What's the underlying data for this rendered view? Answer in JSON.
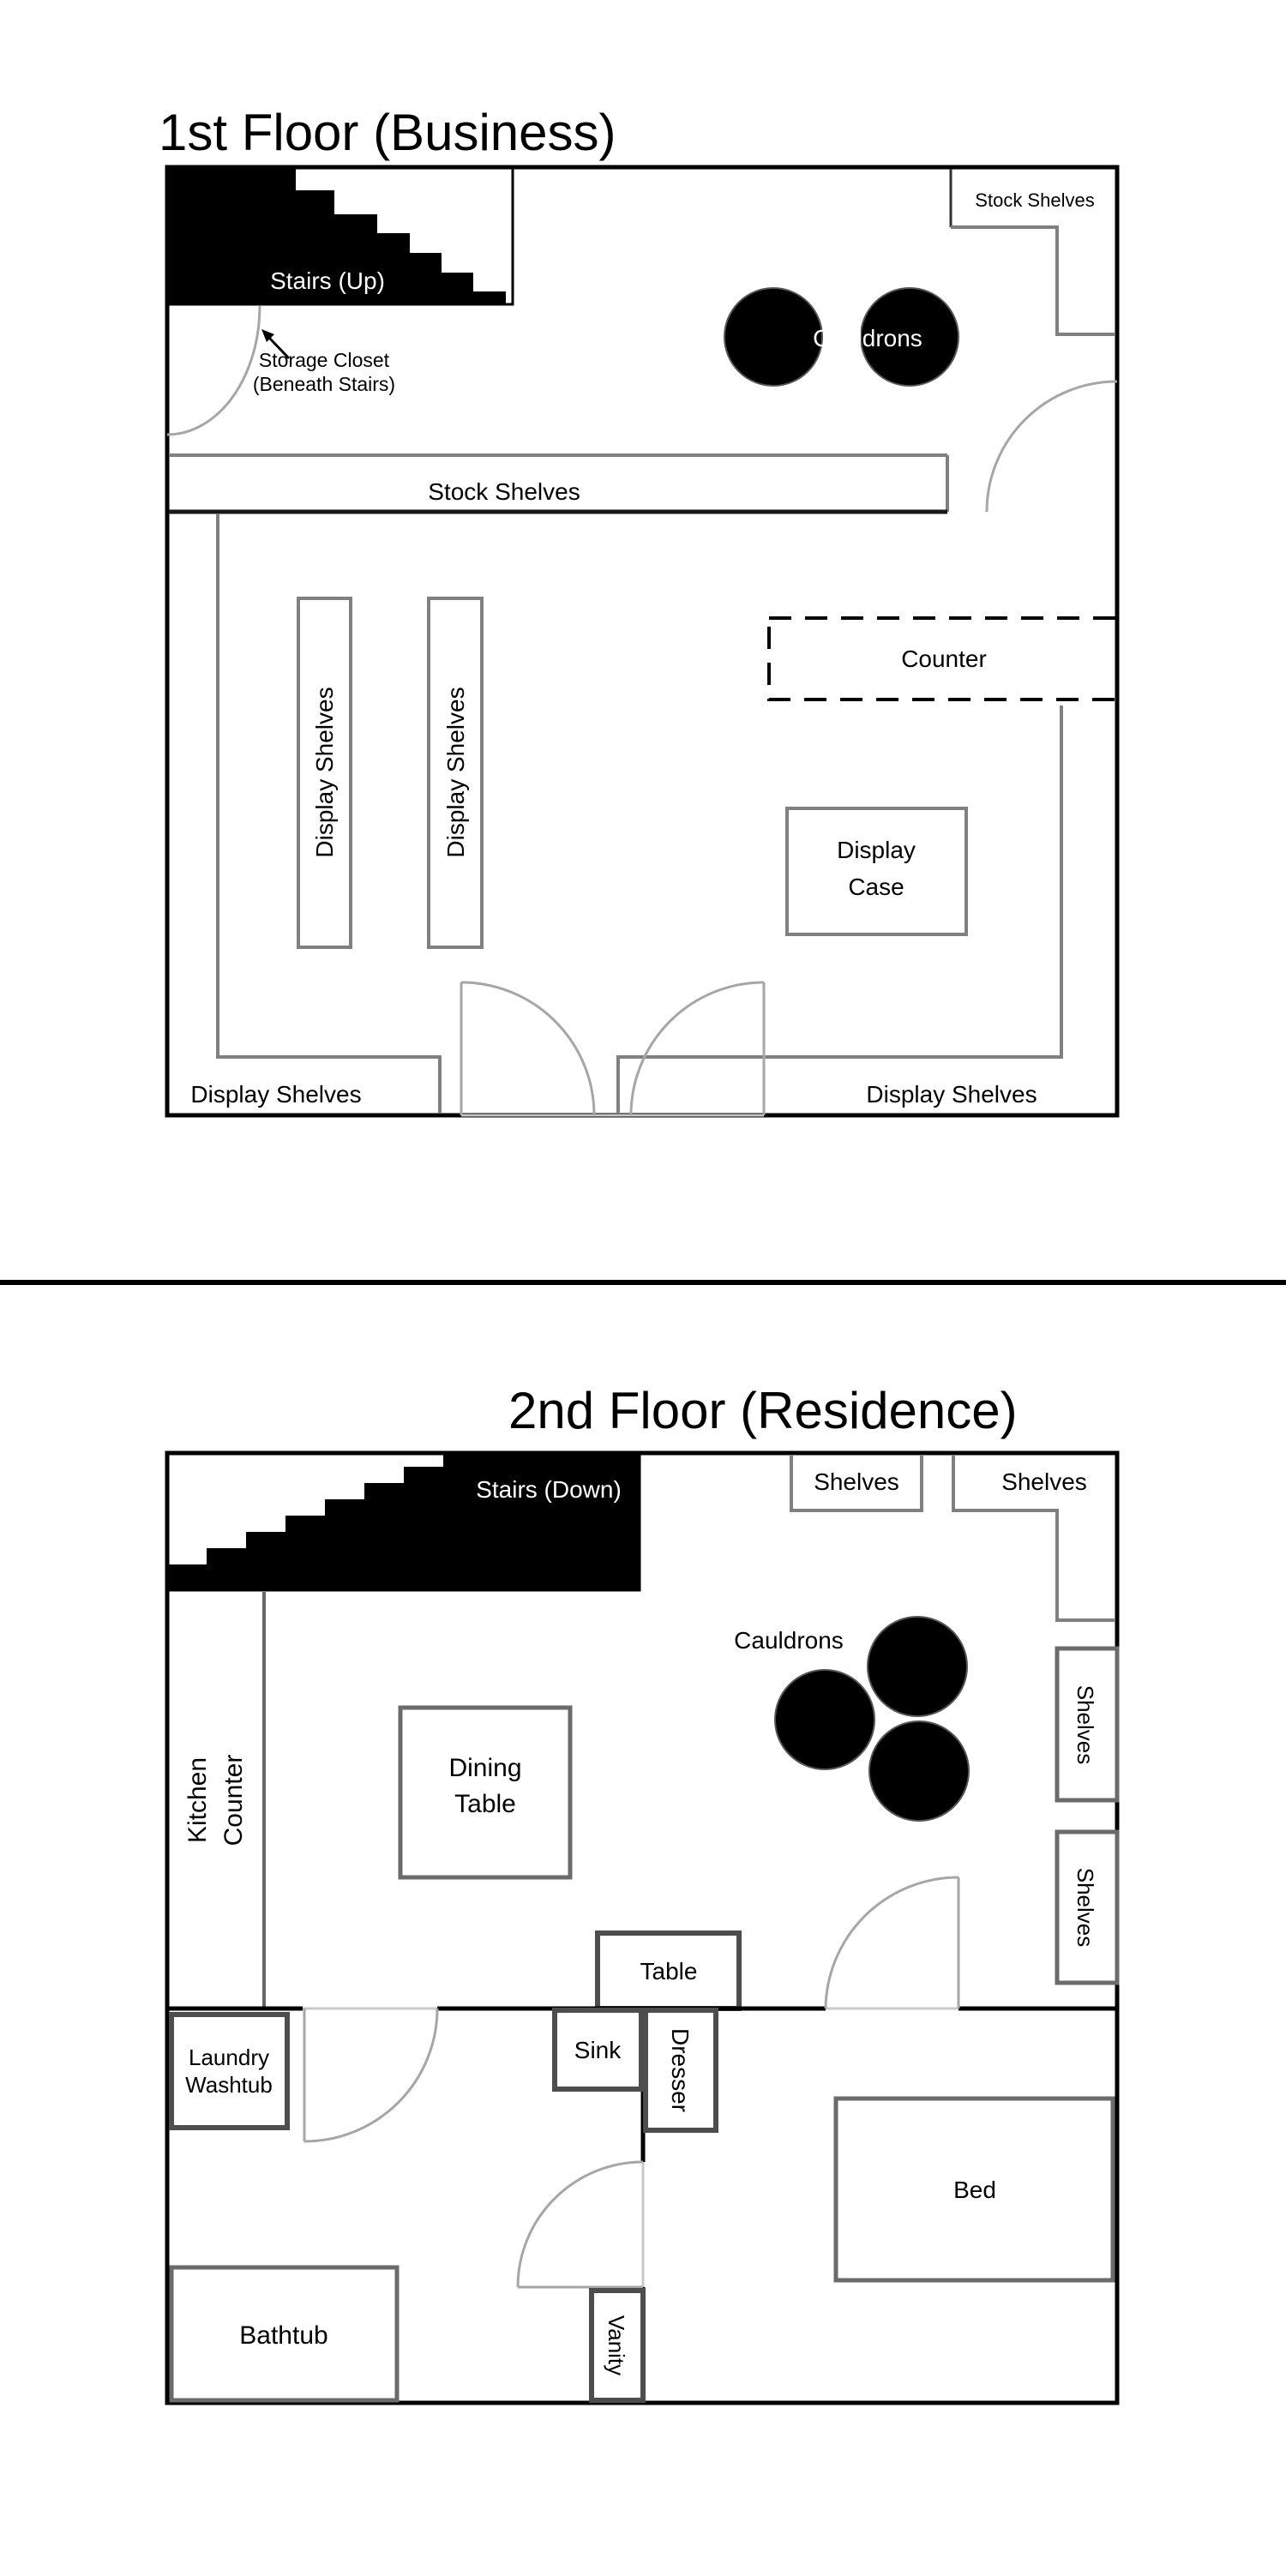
{
  "colors": {
    "wall": "#000000",
    "furniture_gray": "#808080",
    "furniture_dark": "#4d4d4d",
    "door_gray": "#a6a6a6",
    "cauldron_fill": "#000000",
    "stairs_fill": "#000000"
  },
  "floor1": {
    "title": "1st Floor (Business)",
    "stairs_label": "Stairs (Up)",
    "storage_closet_line1": "Storage Closet",
    "storage_closet_line2": "(Beneath Stairs)",
    "stock_shelves_corner_label": "Stock Shelves",
    "cauldrons_label": "Cauldrons",
    "stock_shelves_band_label": "Stock Shelves",
    "counter_label": "Counter",
    "display_shelves_vertical1_label": "Display Shelves",
    "display_shelves_vertical2_label": "Display Shelves",
    "display_case_line1": "Display",
    "display_case_line2": "Case",
    "display_shelves_bottom_left_label": "Display Shelves",
    "display_shelves_bottom_right_label": "Display Shelves"
  },
  "floor2": {
    "title": "2nd Floor (Residence)",
    "stairs_label": "Stairs (Down)",
    "shelves_top_left_label": "Shelves",
    "shelves_top_right_label": "Shelves",
    "shelves_right_upper_label": "Shelves",
    "shelves_right_lower_label": "Shelves",
    "cauldrons_label": "Cauldrons",
    "kitchen_counter_line1": "Kitchen",
    "kitchen_counter_line2": "Counter",
    "dining_table_line1": "Dining",
    "dining_table_line2": "Table",
    "table_label": "Table",
    "laundry_line1": "Laundry",
    "laundry_line2": "Washtub",
    "sink_label": "Sink",
    "dresser_label": "Dresser",
    "bed_label": "Bed",
    "bathtub_label": "Bathtub",
    "vanity_label": "Vanity"
  }
}
